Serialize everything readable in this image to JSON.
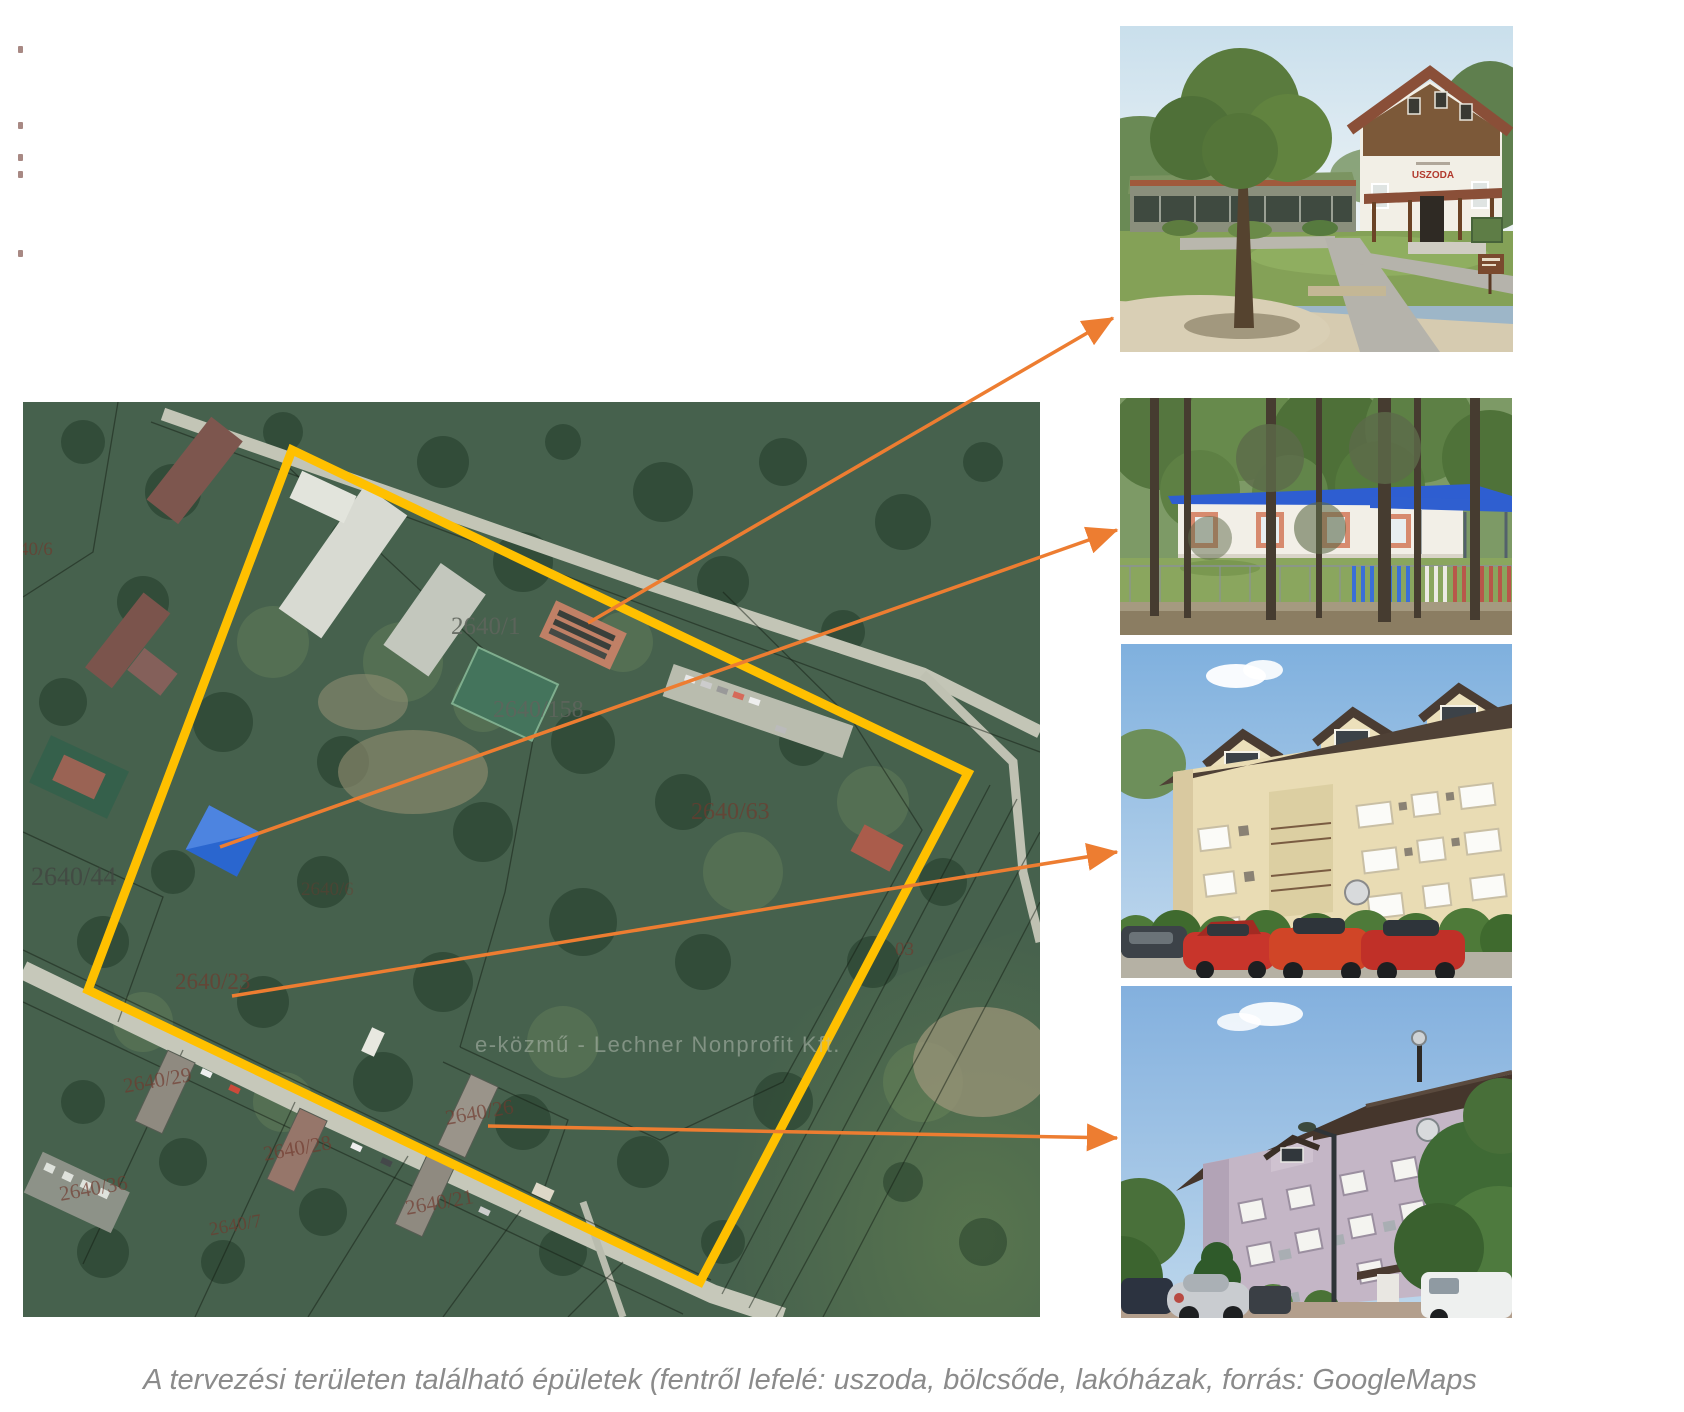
{
  "caption": {
    "text": "A tervezési területen található épületek (fentről lefelé: uszoda, bölcsőde, lakóházak, forrás: GoogleMaps"
  },
  "colors": {
    "highlight_yellow": "#FFC000",
    "arrow_orange": "#ED7D31",
    "caption_gray": "#8B8B8B"
  },
  "map": {
    "watermark": "e-közmű - Lechner Nonprofit Kft.",
    "labels": [
      {
        "text": "2640/1"
      },
      {
        "text": "2640/158"
      },
      {
        "text": "2640/44"
      },
      {
        "text": "2640/63"
      },
      {
        "text": "2640/23"
      },
      {
        "text": "2640/29"
      },
      {
        "text": "2640/28"
      },
      {
        "text": "2640/26"
      },
      {
        "text": "2640/21"
      },
      {
        "text": "2640/36"
      },
      {
        "text": "2640/7"
      },
      {
        "text": "03"
      },
      {
        "text": "40/6"
      },
      {
        "text": "2640/6"
      }
    ]
  },
  "photos": [
    {
      "name": "uszoda",
      "sign_text": "USZODA"
    },
    {
      "name": "bölcsőde"
    },
    {
      "name": "lakóház-1"
    },
    {
      "name": "lakóház-2"
    }
  ]
}
